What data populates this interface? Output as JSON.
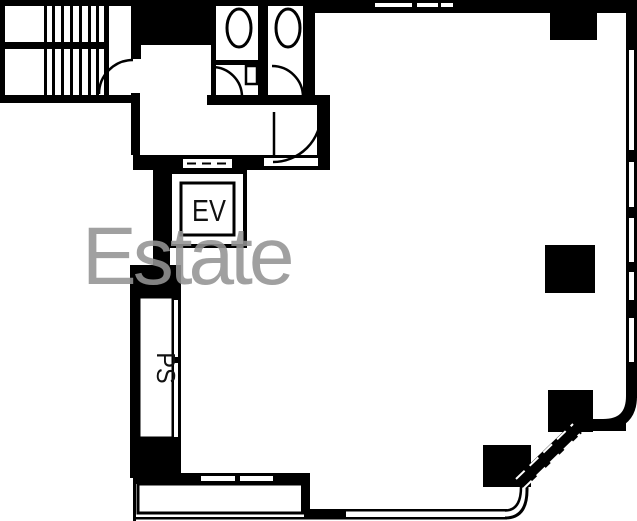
{
  "plan": {
    "type": "building-floor-plan",
    "canvas": {
      "width": 637,
      "height": 521
    },
    "labels": {
      "elevator": "EV",
      "pipe_shaft": "PS"
    },
    "watermark": {
      "text": "Estate"
    },
    "colors": {
      "wall": "#000000",
      "floor": "#ffffff",
      "watermark_gray": "#949494",
      "label_ink": "#111111"
    },
    "icons": {
      "toilet": "ellipse-bowl",
      "staircase": "parallel-treads",
      "door_swing": "quarter-arc",
      "pillar": "filled-square",
      "window": "double-line-with-gap",
      "chamfer_wall": "hatched-diagonal"
    }
  }
}
